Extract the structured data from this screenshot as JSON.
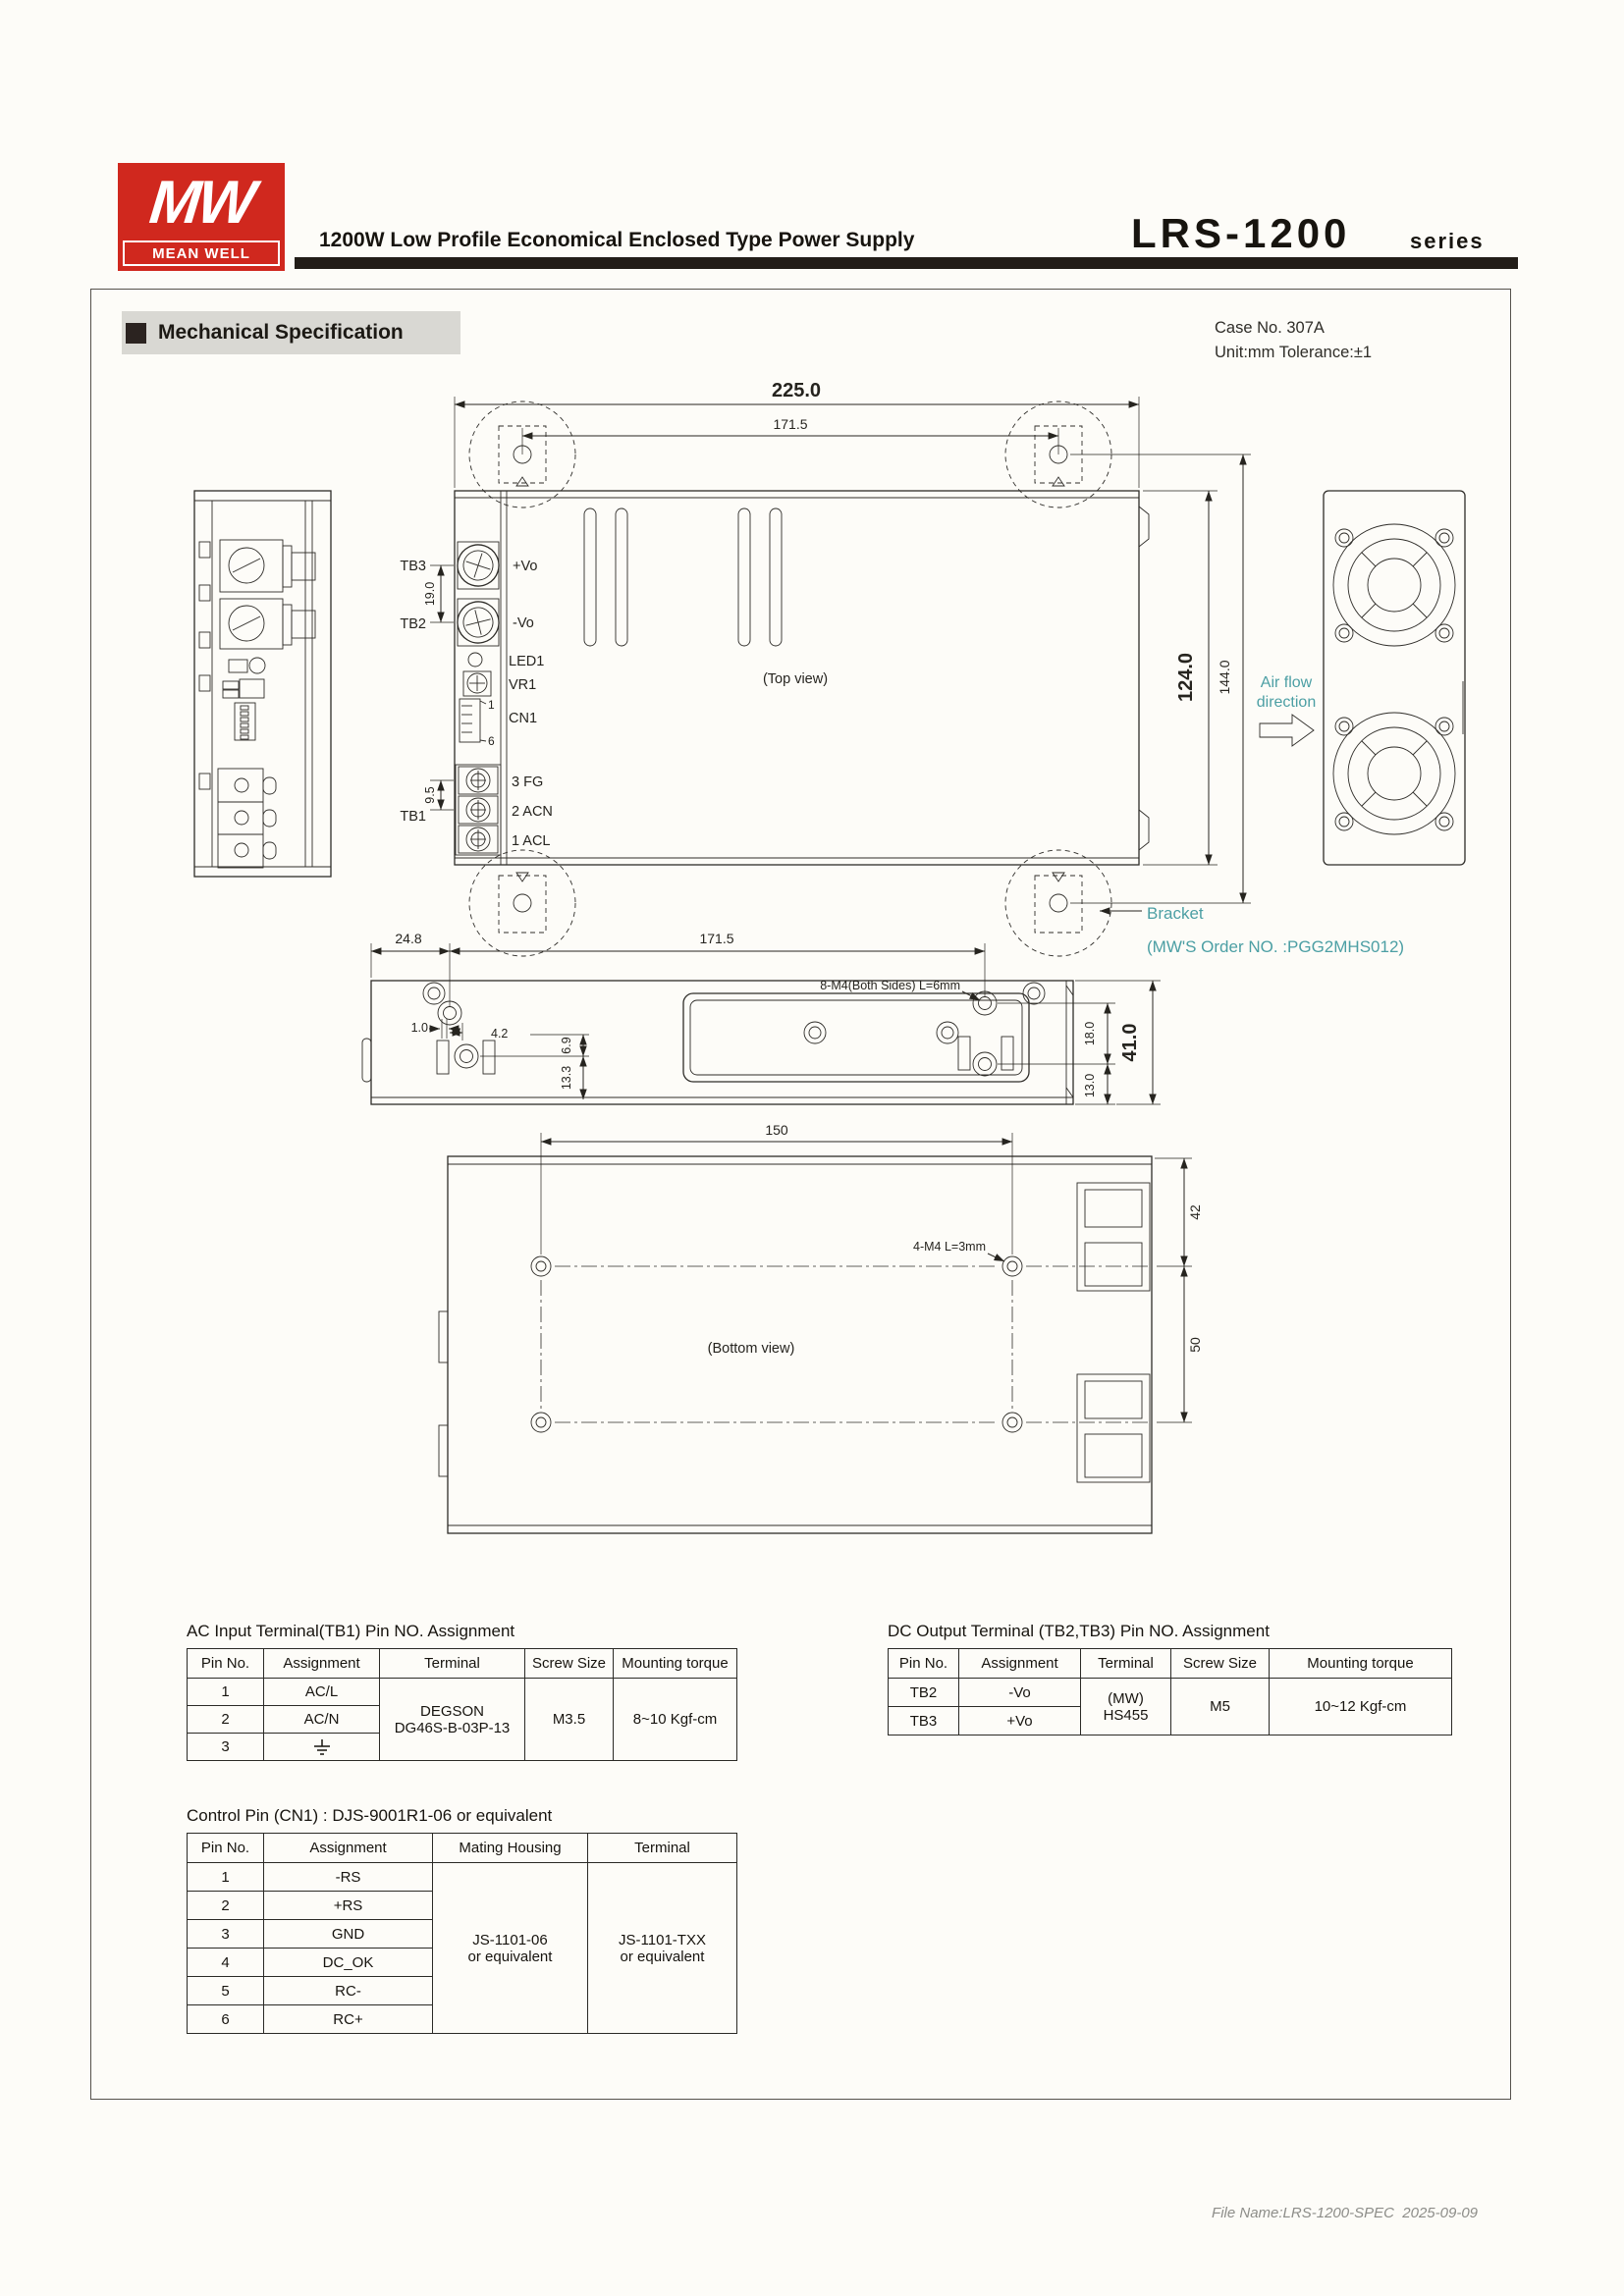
{
  "header": {
    "logo_mw": "MW",
    "logo_brand": "MEAN WELL",
    "title": "1200W Low Profile Economical Enclosed Type Power Supply",
    "series": "LRS-1200",
    "series_suffix": "series"
  },
  "section": {
    "title": "Mechanical Specification"
  },
  "case_info": {
    "line1": "Case No. 307A",
    "line2": "Unit:mm Tolerance:±1"
  },
  "drawing": {
    "top_view": {
      "dim_width": "225.0",
      "dim_bracket_span": "171.5",
      "tb3": "TB3",
      "tb2": "TB2",
      "tb1": "TB1",
      "dim_tb_spacing": "19.0",
      "dim_tb1_spacing": "9.5",
      "plus_vo": "+Vo",
      "minus_vo": "-Vo",
      "led1": "LED1",
      "vr1": "VR1",
      "cn1": "CN1",
      "pin_1": "1",
      "pin_6": "6",
      "fg": "3 FG",
      "acn": "2 ACN",
      "acl": "1 ACL",
      "caption": "(Top view)",
      "dim_depth": "124.0",
      "dim_depth_overall": "144.0"
    },
    "air_flow": {
      "line1": "Air flow",
      "line2": "direction"
    },
    "bracket": {
      "label": "Bracket",
      "order": "(MW'S Order NO. :PGG2MHS012)"
    },
    "side_view": {
      "dim_left": "24.8",
      "dim_span": "171.5",
      "screw_note": "8-M4(Both Sides) L=6mm",
      "dim_1_0": "1.0",
      "dim_4_2": "4.2",
      "dim_6_9": "6.9",
      "dim_13_3": "13.3",
      "dim_18": "18.0",
      "dim_13": "13.0",
      "dim_height": "41.0"
    },
    "bottom_view": {
      "dim_hole_span": "150",
      "screw_note": "4-M4 L=3mm",
      "caption": "(Bottom view)",
      "dim_42": "42",
      "dim_50": "50"
    }
  },
  "tables": {
    "ac_input": {
      "title": "AC Input Terminal(TB1) Pin NO. Assignment",
      "headers": [
        "Pin No.",
        "Assignment",
        "Terminal",
        "Screw Size",
        "Mounting torque"
      ],
      "rows": [
        [
          "1",
          "AC/L"
        ],
        [
          "2",
          "AC/N"
        ],
        [
          "3",
          ""
        ]
      ],
      "terminal_line1": "DEGSON",
      "terminal_line2": "DG46S-B-03P-13",
      "screw": "M3.5",
      "torque": "8~10 Kgf-cm"
    },
    "dc_output": {
      "title": "DC Output Terminal (TB2,TB3) Pin NO. Assignment",
      "headers": [
        "Pin No.",
        "Assignment",
        "Terminal",
        "Screw Size",
        "Mounting torque"
      ],
      "rows": [
        [
          "TB2",
          "-Vo"
        ],
        [
          "TB3",
          "+Vo"
        ]
      ],
      "terminal_line1": "(MW)",
      "terminal_line2": "HS455",
      "screw": "M5",
      "torque": "10~12 Kgf-cm"
    },
    "control_pin": {
      "title": "Control Pin (CN1) : DJS-9001R1-06 or equivalent",
      "headers": [
        "Pin No.",
        "Assignment",
        "Mating Housing",
        "Terminal"
      ],
      "rows": [
        [
          "1",
          "-RS"
        ],
        [
          "2",
          "+RS"
        ],
        [
          "3",
          "GND"
        ],
        [
          "4",
          "DC_OK"
        ],
        [
          "5",
          "RC-"
        ],
        [
          "6",
          "RC+"
        ]
      ],
      "housing_line1": "JS-1101-06",
      "housing_line2": "or equivalent",
      "terminal_line1": "JS-1101-TXX",
      "terminal_line2": "or equivalent"
    }
  },
  "footer": {
    "file_name": "File Name:LRS-1200-SPEC  2025-09-09"
  }
}
